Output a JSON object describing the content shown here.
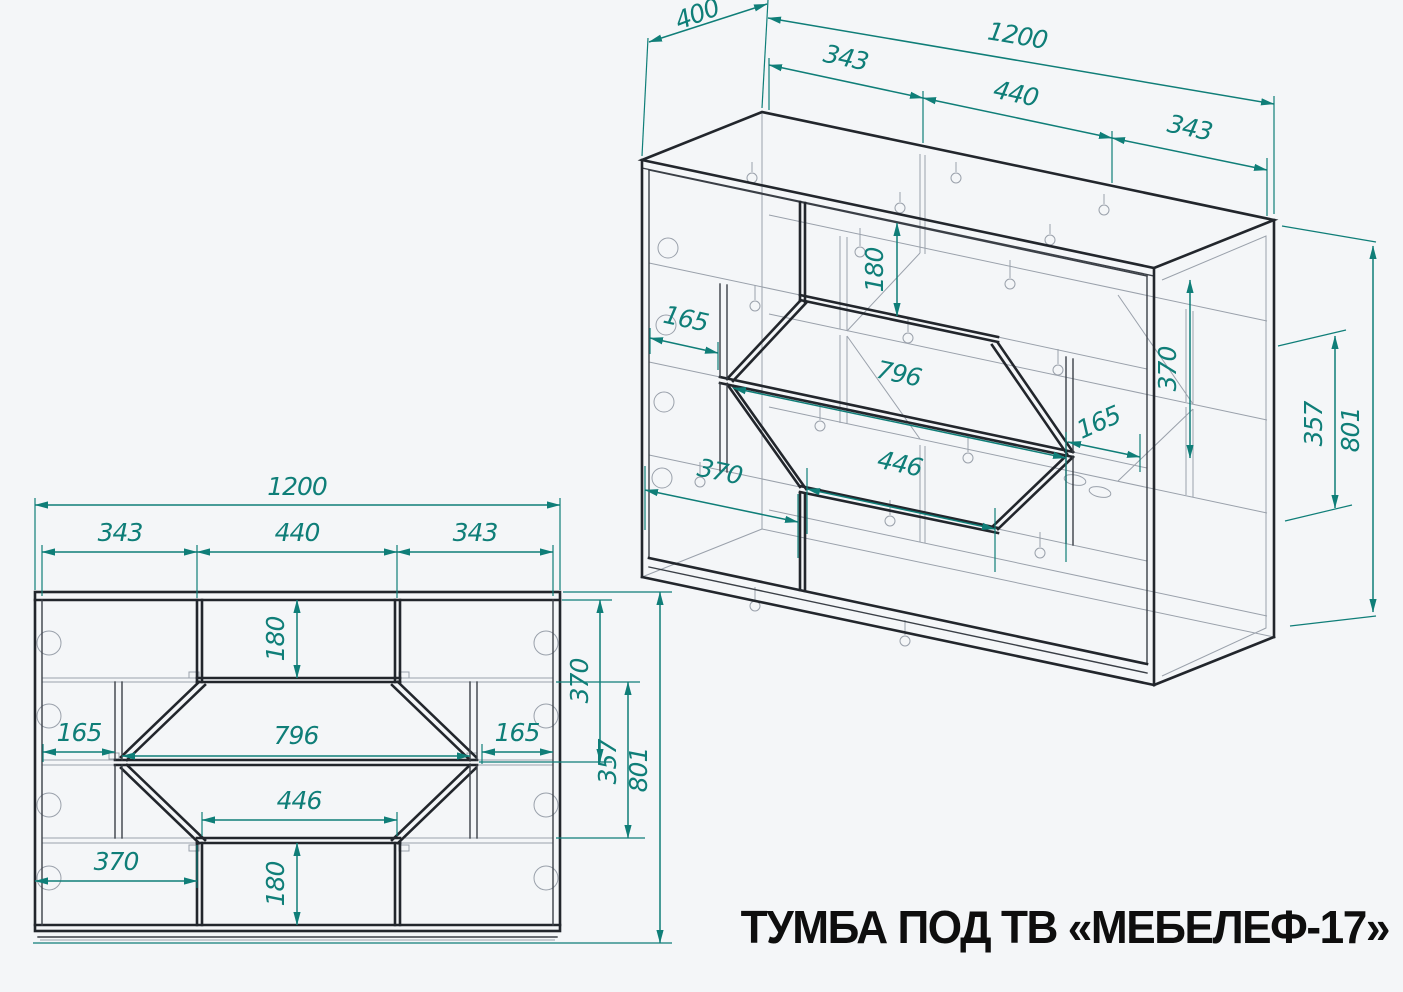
{
  "title": "ТУМБА ПОД ТВ «МЕБЕЛЕФ-17»",
  "colors": {
    "dimension_accent": "#0f7e78",
    "carcass_line": "#22262c",
    "construction_line": "#9aa1ab",
    "background": "#f4f6f8",
    "title_color": "#0e0e0e"
  },
  "iso": {
    "depth": "400",
    "width": "1200",
    "section_left": "343",
    "section_middle": "440",
    "section_right": "343",
    "niche_height": "180",
    "recess_left": "165",
    "shelf_middle": "796",
    "shelf_bottom": "446",
    "bottom_left_width": "370",
    "recess_right": "165",
    "height_upper": "370",
    "shelf_gap": "357",
    "height_total": "801"
  },
  "front": {
    "width": "1200",
    "section_left": "343",
    "section_middle": "440",
    "section_right": "343",
    "niche_top_height": "180",
    "height_upper_right": "370",
    "recess_left": "165",
    "shelf_middle": "796",
    "recess_right": "165",
    "shelf_gap": "357",
    "height_total": "801",
    "shelf_bottom": "446",
    "bottom_left_width": "370",
    "niche_bottom_height": "180"
  }
}
